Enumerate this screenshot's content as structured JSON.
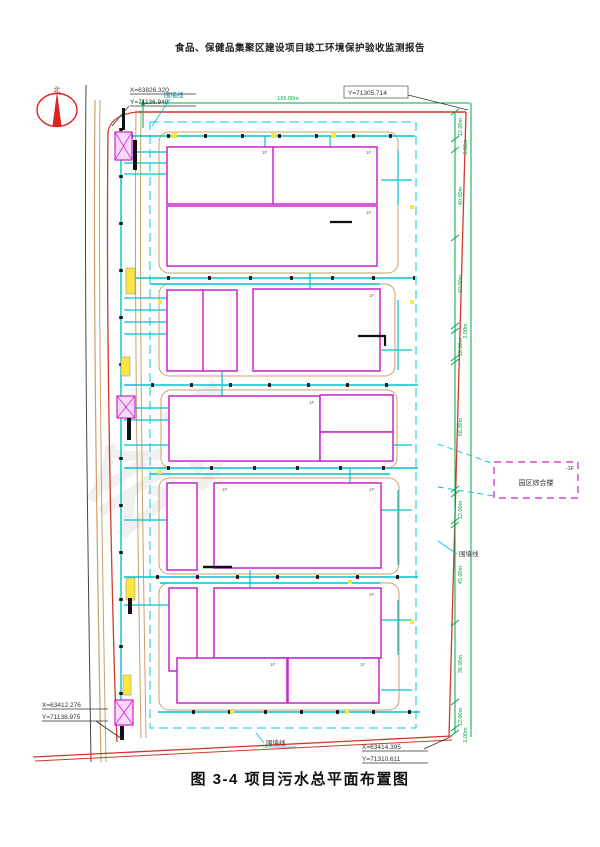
{
  "header": {
    "title": "食品、保健品集聚区建设项目竣工环境保护验收监测报告"
  },
  "figure": {
    "caption": "图 3-4 项目污水总平面布置图"
  },
  "compass": {
    "north": "北"
  },
  "callouts": {
    "top_left_x": "X=63826.320",
    "top_left_y": "Y=71136.948",
    "top_right_y": "Y=71305.714",
    "bottom_left_x": "X=63412.276",
    "bottom_left_y": "Y=71138.975",
    "bottom_right_x": "X=63414.395",
    "bottom_right_y": "Y=71310.611"
  },
  "labels": {
    "fence_top": "围墙线",
    "fence_right": "围墙线",
    "fence_bottom": "围墙线",
    "complex_building": "园区综合楼",
    "complex_floor": "-1F",
    "top_dimension": "165.00m",
    "floor_mark": "1F"
  },
  "dimensions_right": [
    "12.00m",
    "5.00m",
    "40.00m",
    "40.00m",
    "2.00m",
    "12.00m",
    "58.00m",
    "12.00m",
    "45.00m",
    "36.00m",
    "12.00m",
    "1.00m"
  ],
  "watermark": "会员",
  "colors": {
    "building": "#cc22cc",
    "pipe": "#00c3d0",
    "fence_red": "#cf3a2e",
    "dim_green": "#00a843",
    "road_tan": "#c9a06b"
  }
}
